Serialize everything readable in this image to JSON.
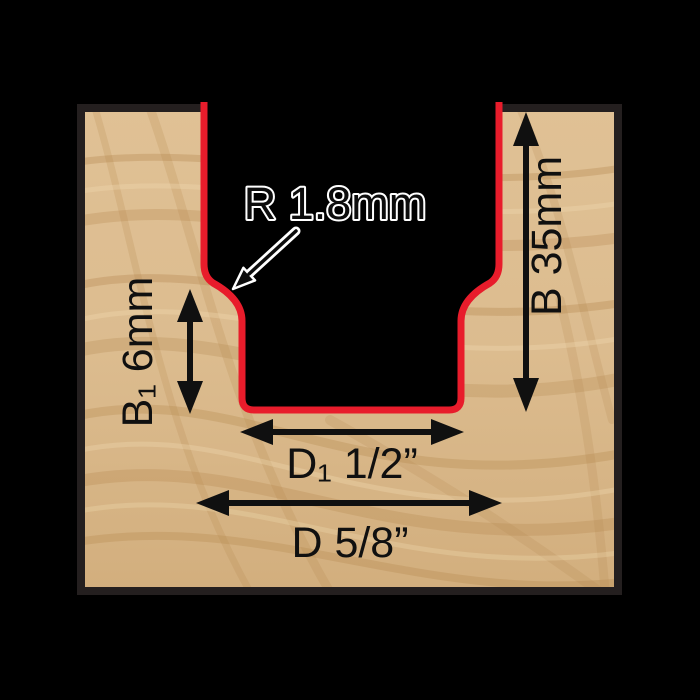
{
  "diagram": {
    "subject": "groove-profile-cross-section",
    "callout": {
      "radius_label": "R 1.8mm"
    },
    "dimensions": {
      "cut_depth": {
        "label": "B 35mm"
      },
      "step_depth": {
        "label": "B₁ 6mm"
      },
      "inner_width": {
        "label": "D₁ 1/2”"
      },
      "outer_width": {
        "label": "D 5/8”"
      }
    },
    "colors": {
      "profile_red": "#e81c2b",
      "wood_border": "#241f1f",
      "wood_base": "#dcbc8f",
      "wood_grain_dark": "#b5884f",
      "wood_grain_light": "#f2deb4",
      "dimension_ink": "#101010",
      "callout_halo": "#ffffff",
      "background": "#000000"
    }
  }
}
